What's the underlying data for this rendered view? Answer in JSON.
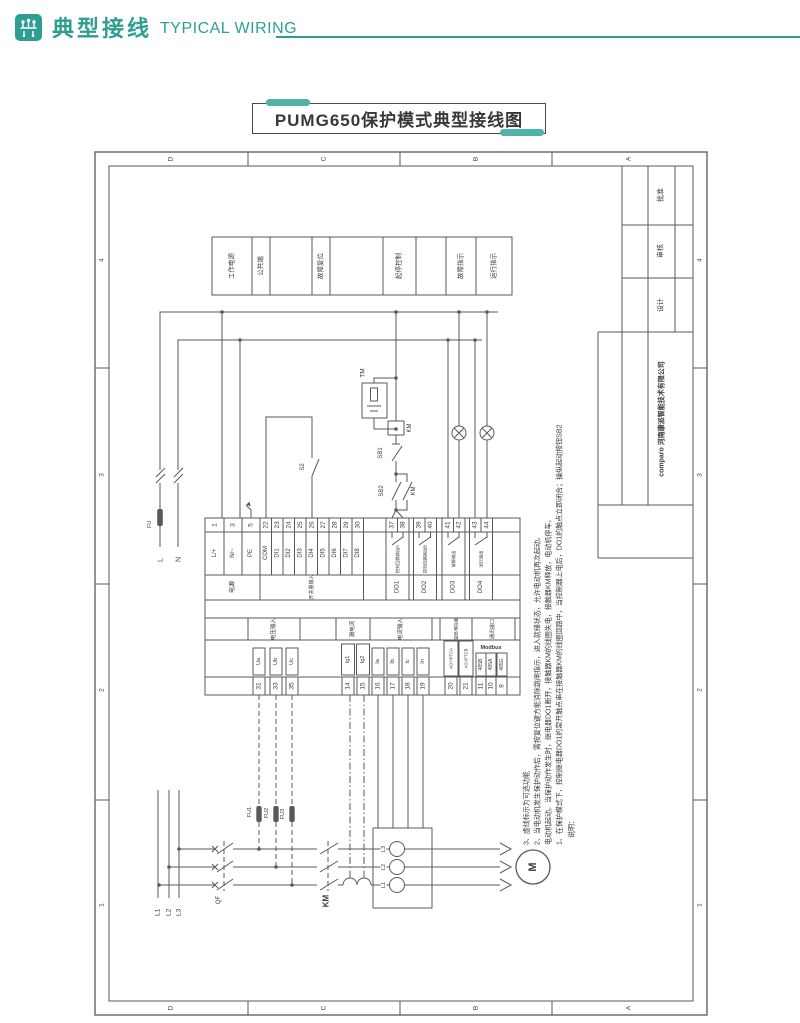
{
  "header": {
    "title_zh": "典型接线",
    "title_en": "TYPICAL WIRING",
    "accent_color": "#2E9E93"
  },
  "doc_title": "PUMG650保护模式典型接线图",
  "sheet": {
    "zone_letters": [
      "D",
      "C",
      "B",
      "A"
    ],
    "zone_numbers": [
      "4",
      "3",
      "2",
      "1"
    ],
    "title_block": {
      "approve": "批准",
      "review": "审核",
      "design": "设计",
      "company": "comparo 河南康派智能技术有限公司"
    }
  },
  "legend": [
    {
      "label": "工作电源"
    },
    {
      "label": "公共端"
    },
    {
      "label": "故障复位"
    },
    {
      "label": "起停控制"
    },
    {
      "label": "故障指示"
    },
    {
      "label": "运行指示"
    }
  ],
  "supply": {
    "l": "L",
    "n": "N",
    "fuse": "FU",
    "phases": [
      "L1",
      "L2",
      "L3"
    ]
  },
  "control": {
    "tm": "TM",
    "km_coil": "KM",
    "sb1": "SB1",
    "sb2": "SB2",
    "km_aux": "KM",
    "s2": "S2"
  },
  "power_circuit": {
    "qf": "QF",
    "km": "KM",
    "fuses": [
      "FU1",
      "FU2",
      "FU3"
    ],
    "ct_box_labels": [
      "L3",
      "L2",
      "L1"
    ],
    "motor": "M"
  },
  "device": {
    "rows": {
      "power": "电源",
      "di": "开关量输入"
    },
    "power_terminals": [
      {
        "num": "1",
        "label": "L/+"
      },
      {
        "num": "3",
        "label": "N/~"
      },
      {
        "num": "5",
        "label": "PE"
      }
    ],
    "di_terminals": [
      {
        "num": "22",
        "label": "COM"
      },
      {
        "num": "23",
        "label": "DI1"
      },
      {
        "num": "24",
        "label": "DI2"
      },
      {
        "num": "25",
        "label": "DI3"
      },
      {
        "num": "26",
        "label": "DI4"
      },
      {
        "num": "27",
        "label": "DI5"
      },
      {
        "num": "28",
        "label": "DI6"
      },
      {
        "num": "29",
        "label": "DI7"
      },
      {
        "num": "30",
        "label": "DI8"
      }
    ],
    "do_groups": [
      {
        "name": "DO1",
        "t1": "37",
        "t2": "38",
        "note": "控制回路输出A"
      },
      {
        "name": "DO2",
        "t1": "39",
        "t2": "40",
        "note": "控制回路输出B"
      },
      {
        "name": "DO3",
        "t1": "41",
        "t2": "42",
        "note": "故障输出"
      },
      {
        "name": "DO4",
        "t1": "43",
        "t2": "44",
        "note": "运行输出"
      }
    ],
    "bottom_groups": [
      {
        "title": "电压输入",
        "terminals": [
          {
            "num": "31",
            "label": "Ua"
          },
          {
            "num": "33",
            "label": "Ub"
          },
          {
            "num": "35",
            "label": "Uc"
          }
        ]
      },
      {
        "title": "漏电流",
        "terminals": [
          {
            "num": "14",
            "label": "Ig1"
          },
          {
            "num": "15",
            "label": "Ig2"
          }
        ]
      },
      {
        "title": "电流输入",
        "terminals": [
          {
            "num": "16",
            "label": "Ia"
          },
          {
            "num": "17",
            "label": "Ib"
          },
          {
            "num": "18",
            "label": "Ic"
          },
          {
            "num": "19",
            "label": "In"
          }
        ]
      },
      {
        "title": "温度/模拟量",
        "terminals": [
          {
            "num": "20",
            "label": "AO+/PTCA"
          },
          {
            "num": "21",
            "label": "AO-/PTCB"
          }
        ]
      },
      {
        "title": "通讯接口",
        "subtitle": "Modbus",
        "terminals": [
          {
            "num": "11",
            "label": "485B"
          },
          {
            "num": "10",
            "label": "485A"
          },
          {
            "num": "9",
            "label": "485G"
          }
        ]
      }
    ]
  },
  "notes": [
    "说明：",
    "1、在保护模式下，控制继电器DO1的常开触点串在接触器KM的线圈回路中，当控制器上电后，DO1的触点立即闭合；操纵起动按钮SB2",
    "电动机起动。当保护动作发生时，继电器DO1断开，接触器KM的线圈失电，接触器KM释放，电动机停车。",
    "2、当电动机发生保护动作后，需按复位键方能消除跳闸指示，进入就绪状态，允许电动机再次起动。",
    "3、虚线标示为可选功能"
  ]
}
